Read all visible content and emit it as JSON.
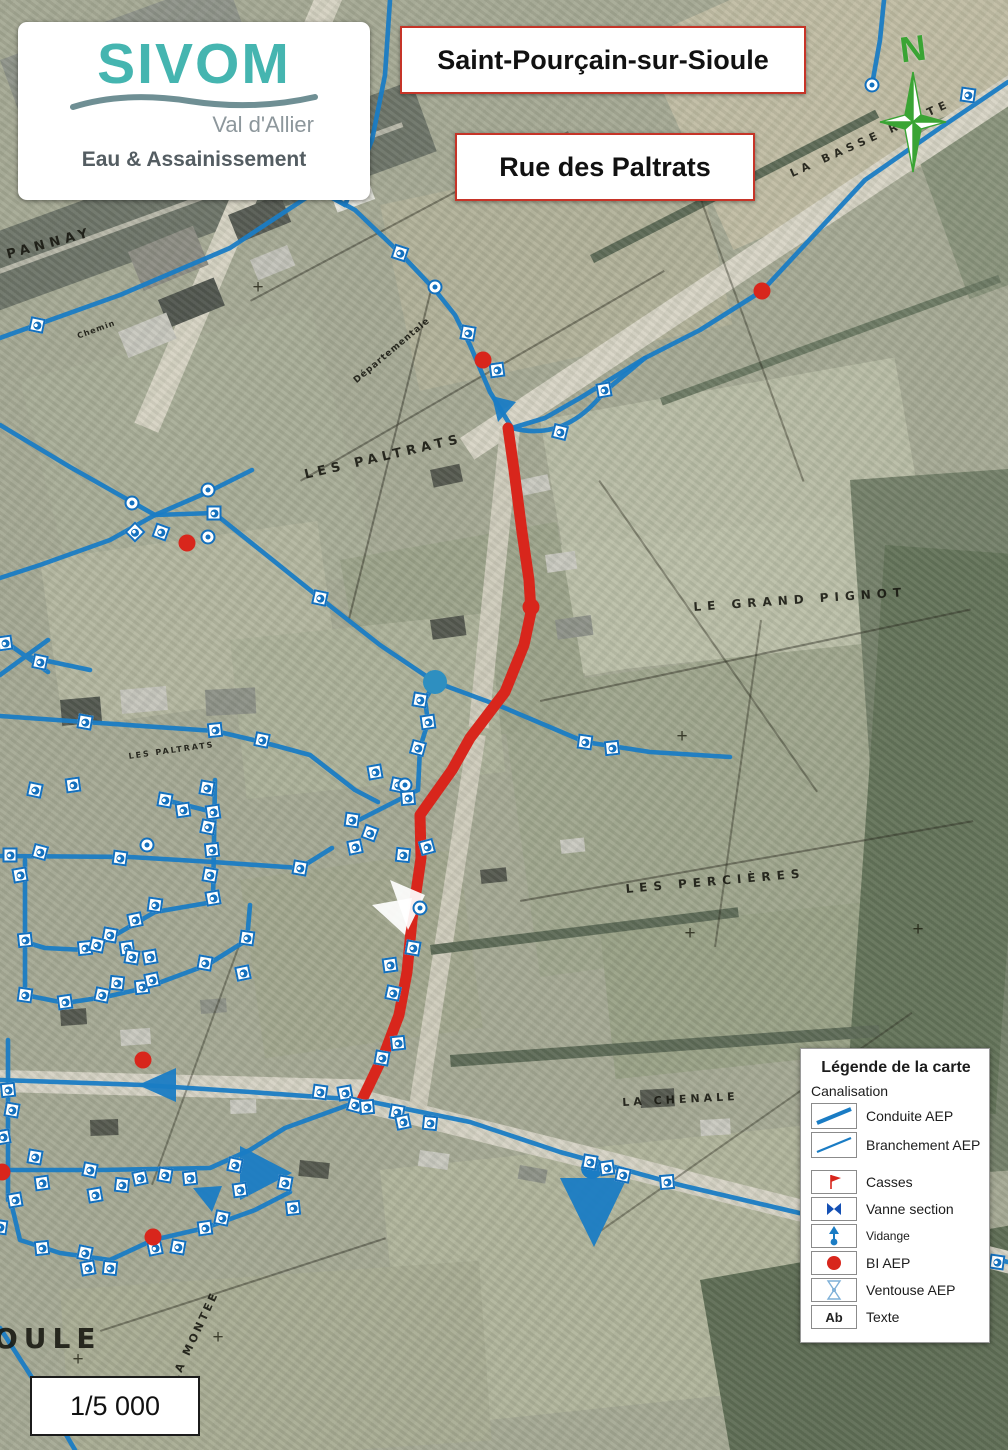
{
  "logo": {
    "org": "SIVOM",
    "region": "Val d'Allier",
    "dept": "Eau & Assainissement"
  },
  "titles": {
    "municipality": "Saint-Pourçain-sur-Sioule",
    "street": "Rue des Paltrats"
  },
  "compass": {
    "north_label": "N"
  },
  "scale": {
    "value": "1/5 000"
  },
  "legend": {
    "title": "Légende de la carte",
    "section": "Canalisation",
    "items": [
      {
        "label": "Conduite AEP",
        "symbol": "conduite-aep-line"
      },
      {
        "label": "Branchement AEP",
        "symbol": "branchement-aep-line"
      },
      {
        "label": "Casses",
        "symbol": "casses-flag"
      },
      {
        "label": "Vanne section",
        "symbol": "vanne-section-bowtie"
      },
      {
        "label": "Vidange",
        "symbol": "vidange-arrow"
      },
      {
        "label": "BI AEP",
        "symbol": "bi-aep-dot"
      },
      {
        "label": "Ventouse AEP",
        "symbol": "ventouse-aep-hourglass"
      },
      {
        "label": "Texte",
        "symbol": "text-sample",
        "glyph": "Ab"
      }
    ]
  },
  "map": {
    "colors": {
      "pipe": "#1a7cc4",
      "route": "#d8261c",
      "bi": "#d8261c",
      "marker_blue": "#1470bd"
    },
    "place_labels": [
      {
        "text": "PANNAY",
        "x": 5,
        "y": 248,
        "rot": -15,
        "fs": 13,
        "ls": 5
      },
      {
        "text": "LES PALTRATS",
        "x": 303,
        "y": 468,
        "rot": -13,
        "fs": 13,
        "ls": 5
      },
      {
        "text": "LES PALTRATS",
        "x": 128,
        "y": 752,
        "rot": -8,
        "fs": 8,
        "ls": 2
      },
      {
        "text": "LE GRAND PIGNOT",
        "x": 693,
        "y": 600,
        "rot": -4,
        "fs": 12,
        "ls": 6
      },
      {
        "text": "LES PERCIÈRES",
        "x": 625,
        "y": 882,
        "rot": -5,
        "fs": 12,
        "ls": 6
      },
      {
        "text": "LA CHENALE",
        "x": 622,
        "y": 1096,
        "rot": -3,
        "fs": 11,
        "ls": 4
      },
      {
        "text": "LA BASSE ROUTE",
        "x": 788,
        "y": 168,
        "rot": -24,
        "fs": 11,
        "ls": 5
      },
      {
        "text": "OULE",
        "x": -6,
        "y": 1322,
        "rot": 0,
        "fs": 28,
        "ls": 6,
        "bold": true
      },
      {
        "text": "LA MONTEE",
        "x": 168,
        "y": 1378,
        "rot": -65,
        "fs": 11,
        "ls": 3
      },
      {
        "text": "Départementale",
        "x": 352,
        "y": 378,
        "rot": -40,
        "fs": 9,
        "ls": 1
      },
      {
        "text": "Chemin",
        "x": 76,
        "y": 332,
        "rot": -20,
        "fs": 8,
        "ls": 1
      }
    ],
    "crosses": [
      [
        258,
        288
      ],
      [
        682,
        737
      ],
      [
        690,
        934
      ],
      [
        218,
        1338
      ],
      [
        78,
        1360
      ],
      [
        918,
        930
      ]
    ],
    "pipes": [
      "M 1008 82 L 940 128 L 865 180 L 762 291 L 700 330 L 645 358 L 580 398 L 545 418 L 512 428",
      "M 512 428 L 490 392 L 470 345 L 455 315 L 435 290 L 400 253 L 355 210 L 318 190",
      "M 0 338 L 120 295 L 230 248 L 318 190 L 345 205",
      "M 345 205 L 372 140 L 385 75 L 390 0",
      "M 872 85 L 880 40 L 884 0",
      "M 512 428 Q 565 442 604 392 L 645 358",
      "M 0 425 L 70 467 L 155 515",
      "M 155 515 L 208 492 L 252 470",
      "M 155 515 L 110 540 L 40 565 L 0 578",
      "M 155 515 L 214 513 L 320 598 L 380 645 L 435 682",
      "M 435 682 L 500 706 L 545 725 L 585 742 L 650 752 L 730 757",
      "M 435 682 L 425 700 L 428 722 L 420 748 L 418 790 L 355 822",
      "M 0 638 L 48 672 M 0 675 L 48 640 M 24 656 L 90 670",
      "M 0 716 L 85 722 L 215 731 L 262 742 L 310 755 L 355 790 L 378 802",
      "M 8 1040 L 8 1200",
      "M 0 1080 L 143 1085 L 250 1092 L 362 1100",
      "M 362 1100 L 470 1122 L 560 1152 L 680 1185 L 1008 1262",
      "M 0 1170 L 100 1170 L 210 1168 L 250 1150 L 285 1128 L 362 1100",
      "M 10 1198 L 20 1240 L 60 1253 L 110 1260 L 153 1240 L 205 1228 L 255 1210 L 290 1192",
      "M 215 780 L 213 902",
      "M 0 856 L 130 857 L 213 862",
      "M 213 902 L 155 912 L 110 938 L 85 950 L 45 948 L 25 942",
      "M 25 860 L 25 995",
      "M 25 995 L 65 1003 L 105 997 L 145 988 L 207 965 L 247 940 L 250 905",
      "M 165 800 L 213 812",
      "M 213 862 L 300 868 L 332 848",
      "M 0 1328 L 40 1390 L 75 1450"
    ],
    "route": "M 508 428 L 514 470 L 522 532 L 529 580 L 531 612 L 524 645 L 505 692 L 470 738 L 452 770 L 420 815 L 421 858 L 412 920 L 407 972 L 399 1015 L 385 1052 L 362 1100",
    "markers_square": [
      [
        37,
        325,
        12
      ],
      [
        400,
        253,
        18
      ],
      [
        468,
        333,
        10
      ],
      [
        497,
        370,
        -8
      ],
      [
        560,
        432,
        14
      ],
      [
        604,
        390,
        -10
      ],
      [
        968,
        95,
        8
      ],
      [
        135,
        532,
        45
      ],
      [
        161,
        532,
        20
      ],
      [
        214,
        513,
        0
      ],
      [
        320,
        598,
        12
      ],
      [
        585,
        742,
        8
      ],
      [
        612,
        748,
        -6
      ],
      [
        420,
        700,
        10
      ],
      [
        428,
        722,
        -8
      ],
      [
        418,
        748,
        15
      ],
      [
        375,
        772,
        -10
      ],
      [
        398,
        785,
        12
      ],
      [
        408,
        798,
        -5
      ],
      [
        352,
        820,
        8
      ],
      [
        370,
        833,
        20
      ],
      [
        355,
        847,
        -12
      ],
      [
        403,
        855,
        6
      ],
      [
        427,
        847,
        -15
      ],
      [
        413,
        948,
        10
      ],
      [
        390,
        965,
        -8
      ],
      [
        393,
        993,
        12
      ],
      [
        398,
        1043,
        -6
      ],
      [
        382,
        1058,
        10
      ],
      [
        320,
        1092,
        8
      ],
      [
        345,
        1093,
        -10
      ],
      [
        355,
        1105,
        15
      ],
      [
        367,
        1107,
        -5
      ],
      [
        397,
        1112,
        10
      ],
      [
        403,
        1122,
        -12
      ],
      [
        430,
        1123,
        6
      ],
      [
        590,
        1162,
        10
      ],
      [
        607,
        1168,
        -8
      ],
      [
        623,
        1175,
        12
      ],
      [
        667,
        1182,
        -5
      ],
      [
        997,
        1262,
        8
      ],
      [
        35,
        1157,
        10
      ],
      [
        42,
        1183,
        -8
      ],
      [
        90,
        1170,
        12
      ],
      [
        95,
        1195,
        -10
      ],
      [
        122,
        1185,
        6
      ],
      [
        140,
        1178,
        -12
      ],
      [
        165,
        1175,
        10
      ],
      [
        190,
        1178,
        -6
      ],
      [
        235,
        1165,
        12
      ],
      [
        240,
        1190,
        -8
      ],
      [
        285,
        1183,
        10
      ],
      [
        293,
        1208,
        -6
      ],
      [
        15,
        1200,
        -10
      ],
      [
        0,
        1227,
        8
      ],
      [
        42,
        1248,
        -6
      ],
      [
        85,
        1253,
        12
      ],
      [
        88,
        1268,
        -10
      ],
      [
        110,
        1268,
        6
      ],
      [
        155,
        1248,
        -12
      ],
      [
        178,
        1247,
        10
      ],
      [
        205,
        1228,
        -8
      ],
      [
        222,
        1218,
        12
      ],
      [
        8,
        1090,
        -6
      ],
      [
        12,
        1110,
        10
      ],
      [
        3,
        1137,
        -10
      ],
      [
        25,
        995,
        8
      ],
      [
        65,
        1002,
        -8
      ],
      [
        102,
        995,
        12
      ],
      [
        142,
        987,
        -6
      ],
      [
        205,
        963,
        10
      ],
      [
        243,
        973,
        -12
      ],
      [
        247,
        938,
        8
      ],
      [
        35,
        790,
        12
      ],
      [
        73,
        785,
        -8
      ],
      [
        10,
        855,
        0
      ],
      [
        40,
        852,
        15
      ],
      [
        20,
        875,
        -10
      ],
      [
        120,
        858,
        8
      ],
      [
        25,
        940,
        -6
      ],
      [
        207,
        788,
        10
      ],
      [
        213,
        812,
        -8
      ],
      [
        208,
        827,
        12
      ],
      [
        212,
        850,
        -6
      ],
      [
        210,
        875,
        10
      ],
      [
        213,
        898,
        -10
      ],
      [
        155,
        905,
        8
      ],
      [
        135,
        920,
        -12
      ],
      [
        110,
        935,
        10
      ],
      [
        85,
        948,
        -6
      ],
      [
        97,
        945,
        12
      ],
      [
        127,
        948,
        -8
      ],
      [
        132,
        957,
        10
      ],
      [
        150,
        957,
        -10
      ],
      [
        117,
        983,
        6
      ],
      [
        152,
        980,
        -12
      ],
      [
        165,
        800,
        10
      ],
      [
        183,
        810,
        -8
      ],
      [
        300,
        868,
        10
      ],
      [
        40,
        662,
        12
      ],
      [
        5,
        643,
        -8
      ],
      [
        85,
        722,
        10
      ],
      [
        215,
        730,
        -6
      ],
      [
        262,
        740,
        12
      ]
    ],
    "markers_circle": [
      [
        132,
        503
      ],
      [
        208,
        490
      ],
      [
        208,
        537
      ],
      [
        435,
        287
      ],
      [
        872,
        85
      ],
      [
        147,
        845
      ],
      [
        420,
        908
      ],
      [
        405,
        785
      ]
    ],
    "bi_points": [
      [
        762,
        291
      ],
      [
        483,
        360
      ],
      [
        187,
        543
      ],
      [
        531,
        607
      ],
      [
        143,
        1060
      ],
      [
        153,
        1237
      ],
      [
        2,
        1172
      ]
    ],
    "vidange_points": [
      [
        435,
        682
      ]
    ],
    "domes": [
      [
        592,
        1168
      ]
    ],
    "triangles": [
      [
        [
          560,
          1178
        ],
        [
          627,
          1178
        ],
        [
          594,
          1247
        ]
      ],
      [
        [
          240,
          1146
        ],
        [
          240,
          1200
        ],
        [
          292,
          1173
        ]
      ],
      [
        [
          193,
          1188
        ],
        [
          222,
          1186
        ],
        [
          212,
          1212
        ]
      ],
      [
        [
          176,
          1068
        ],
        [
          176,
          1102
        ],
        [
          138,
          1085
        ]
      ],
      [
        [
          492,
          396
        ],
        [
          516,
          402
        ],
        [
          498,
          422
        ]
      ]
    ],
    "casses_flags": [
      [
        [
          405,
          935
        ],
        [
          372,
          905
        ],
        [
          412,
          898
        ]
      ],
      [
        [
          408,
          930
        ],
        [
          390,
          880
        ],
        [
          425,
          895
        ]
      ]
    ]
  }
}
